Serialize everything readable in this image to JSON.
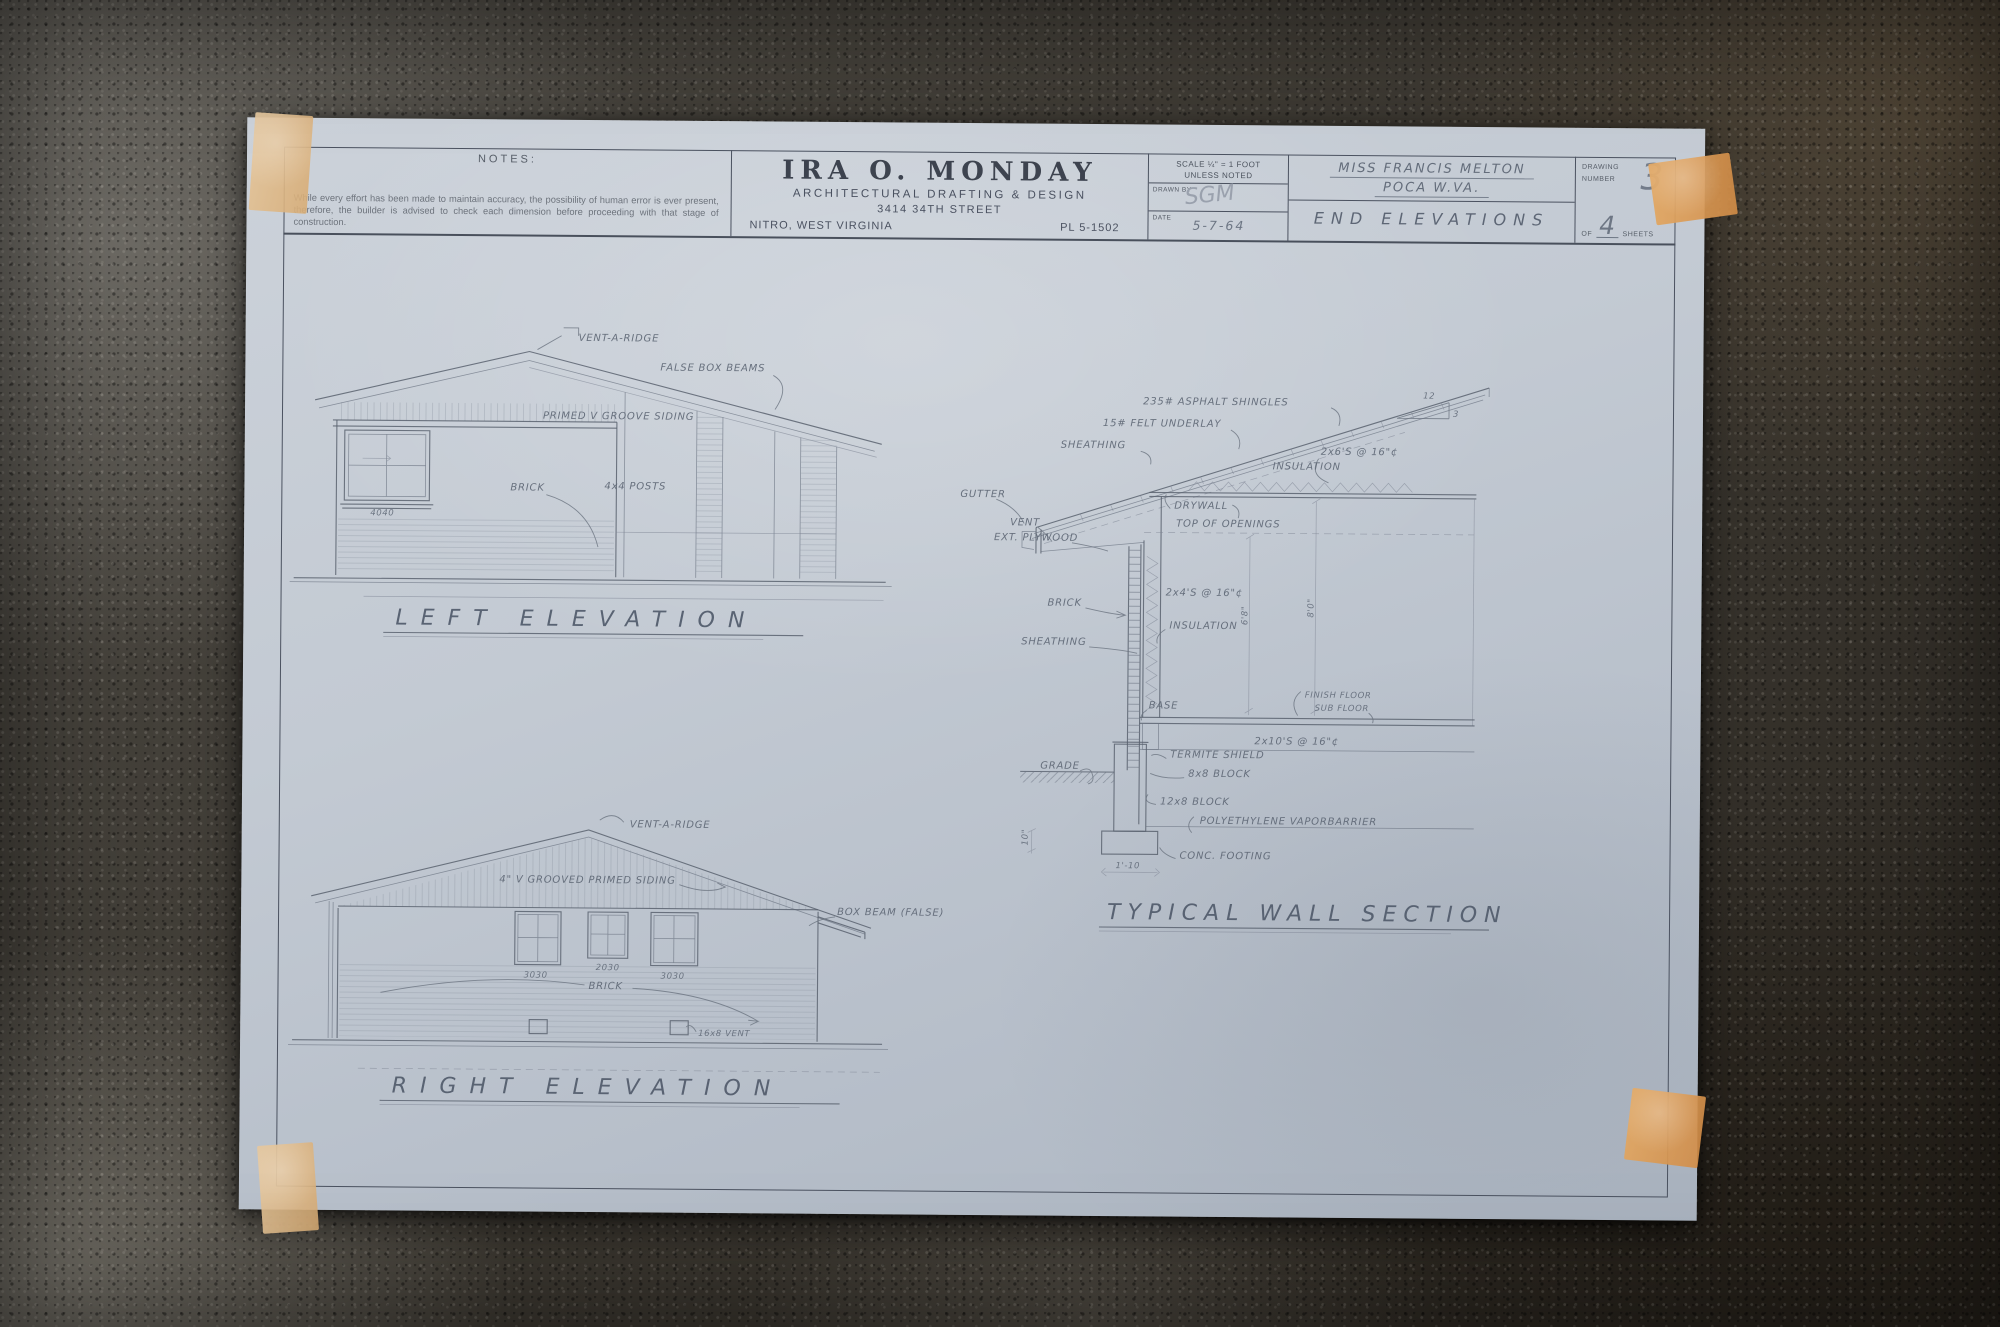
{
  "titlebar": {
    "notes_label": "NOTES:",
    "disclaimer": "While every effort has been made to maintain accuracy, the possibility of human error is ever present, therefore, the builder is advised to check each dimension before proceeding with that stage of construction.",
    "firm_name": "IRA O. MONDAY",
    "firm_tagline": "ARCHITECTURAL DRAFTING & DESIGN",
    "firm_address": "3414 34TH STREET",
    "firm_city": "NITRO, WEST VIRGINIA",
    "firm_phone": "PL 5-1502",
    "scale_line1": "SCALE ¼\" = 1 FOOT",
    "scale_line2": "UNLESS NOTED",
    "drawn_label": "DRAWN BY",
    "drawn_value": "SGM",
    "date_label": "DATE",
    "date_value": "5-7-64",
    "client_name": "MISS FRANCIS MELTON",
    "client_city": "POCA W.VA.",
    "sheet_title": "END ELEVATIONS",
    "number_label_1": "DRAWING",
    "number_label_2": "NUMBER",
    "drawing_number": "3",
    "of_label": "OF",
    "sheet_count": "4",
    "sheets_label": "SHEETS"
  },
  "left_elevation": {
    "title": "LEFT ELEVATION",
    "labels": {
      "vent_a_ridge": "VENT-A-RIDGE",
      "false_box_beams": "FALSE BOX BEAMS",
      "siding": "PRIMED V GROOVE SIDING",
      "brick": "BRICK",
      "posts": "4x4 POSTS",
      "window_size": "4040"
    }
  },
  "right_elevation": {
    "title": "RIGHT ELEVATION",
    "labels": {
      "vent_a_ridge": "VENT-A-RIDGE",
      "siding": "4\" V GROOVED PRIMED SIDING",
      "box_beam": "BOX BEAM (FALSE)",
      "window_left": "3030",
      "window_center": "2030",
      "window_right": "3030",
      "brick": "BRICK",
      "foundation_vent": "16x8 VENT"
    }
  },
  "wall_section": {
    "title": "TYPICAL WALL SECTION",
    "labels": {
      "shingles": "235# ASPHALT SHINGLES",
      "felt": "15# FELT UNDERLAY",
      "roof_sheathing": "SHEATHING",
      "rafters": "2x6'S @ 16\"¢",
      "ceiling_insulation": "INSULATION",
      "slope_run": "12",
      "slope_rise": "3",
      "gutter": "GUTTER",
      "vent": "VENT",
      "ext_plywood": "EXT. PLYWOOD",
      "drywall": "DRYWALL",
      "top_of_openings": "TOP OF OPENINGS",
      "brick": "BRICK",
      "studs": "2x4'S @ 16\"¢",
      "wall_insulation": "INSULATION",
      "wall_sheathing": "SHEATHING",
      "dim_openings": "6'8\"",
      "dim_ceiling": "8'0\"",
      "base": "BASE",
      "finish_floor": "FINISH FLOOR",
      "sub_floor": "SUB FLOOR",
      "joists": "2x10'S @ 16\"¢",
      "grade": "GRADE",
      "termite_shield": "TERMITE SHIELD",
      "block_8x8": "8x8 BLOCK",
      "block_12x8": "12x8 BLOCK",
      "vapor_barrier": "POLYETHYLENE VAPORBARRIER",
      "footing": "CONC. FOOTING",
      "dim_footing_width": "1'-10",
      "dim_footing_height": "10\""
    }
  }
}
